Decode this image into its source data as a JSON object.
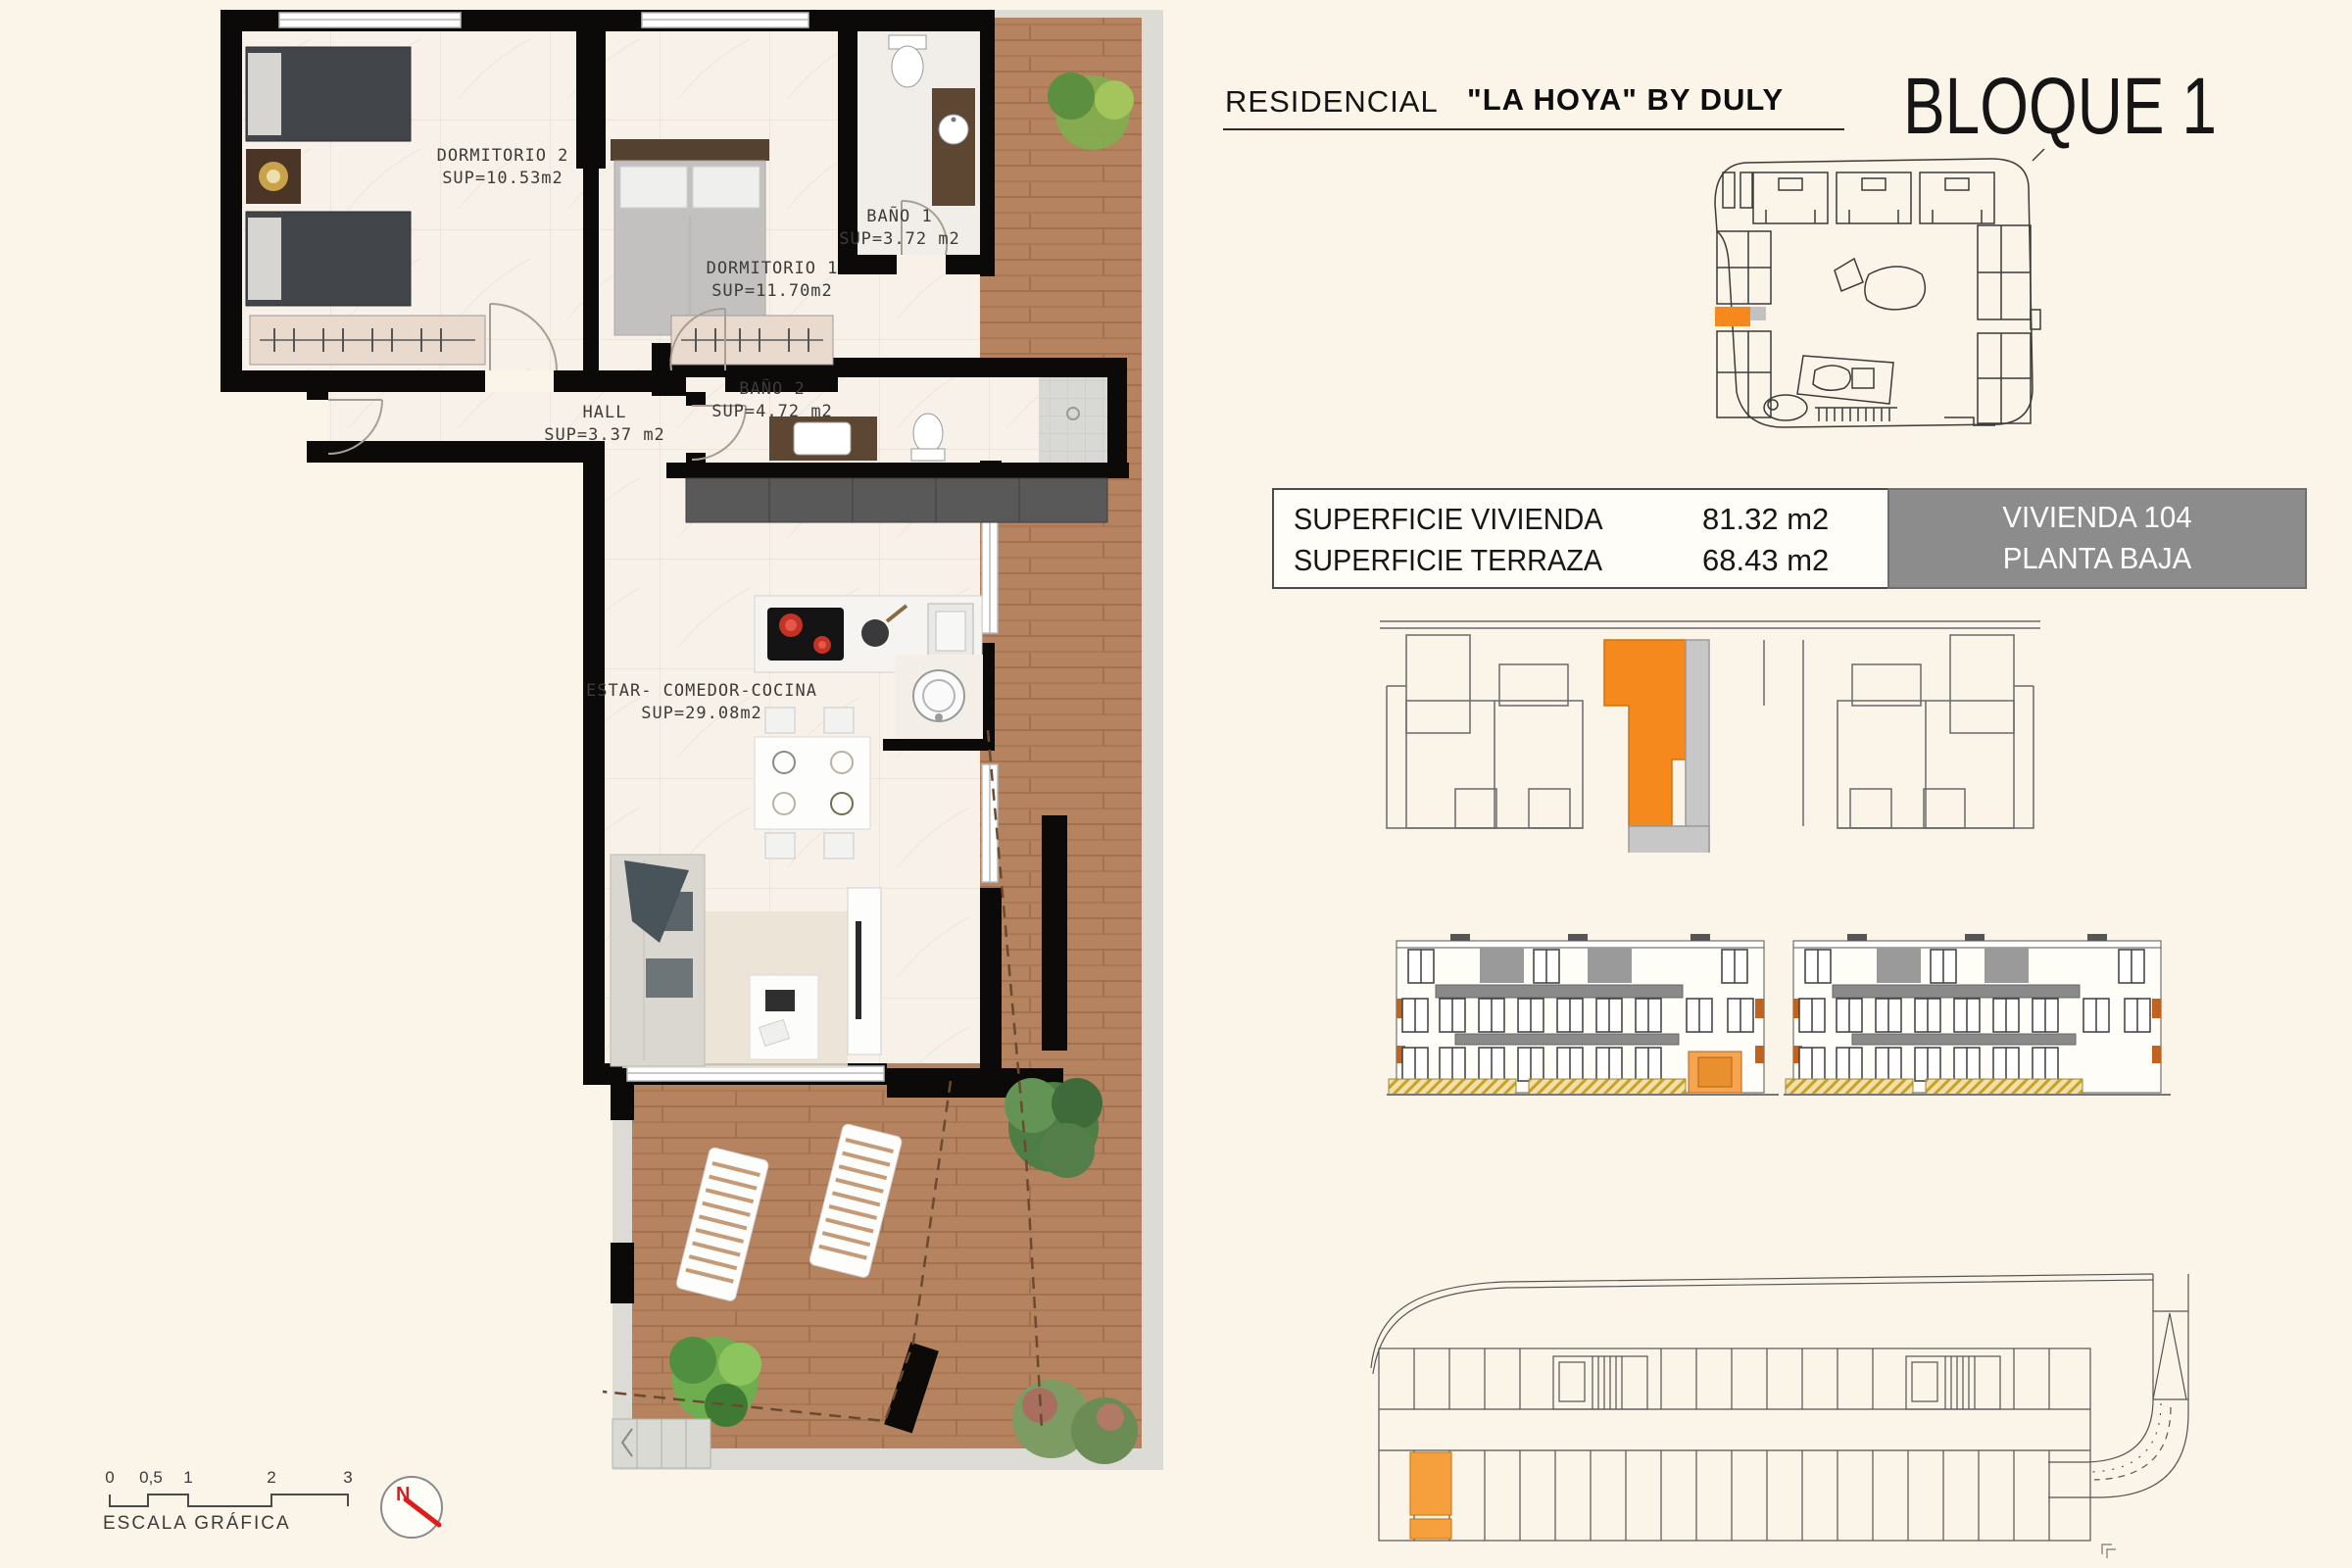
{
  "header": {
    "residencial": "RESIDENCIAL",
    "project": "\"LA HOYA\" BY DULY",
    "block": "BLOQUE 1"
  },
  "info_table": {
    "rows": [
      {
        "label": "SUPERFICIE VIVIENDA",
        "value": "81.32 m2"
      },
      {
        "label": "SUPERFICIE TERRAZA",
        "value": "68.43 m2"
      }
    ],
    "unit_box": {
      "line1": "VIVIENDA 104",
      "line2": "PLANTA BAJA"
    }
  },
  "floor_plan": {
    "rooms": [
      {
        "name": "DORMITORIO 2",
        "sup": "SUP=10.53m2"
      },
      {
        "name": "DORMITORIO 1",
        "sup": "SUP=11.70m2"
      },
      {
        "name": "BAÑO 1",
        "sup": "SUP=3.72 m2"
      },
      {
        "name": "HALL",
        "sup": "SUP=3.37 m2"
      },
      {
        "name": "BAÑO 2",
        "sup": "SUP=4.72 m2"
      },
      {
        "name": "ESTAR- COMEDOR-COCINA",
        "sup": "SUP=29.08m2"
      }
    ]
  },
  "scale_bar": {
    "ticks": [
      "0",
      "0,5",
      "1",
      "2",
      "3"
    ],
    "label": "ESCALA GRÁFICA"
  },
  "north": {
    "letter": "N"
  },
  "colors": {
    "highlight_orange": "#F5891D",
    "unit_box_gray": "#8C8C8C",
    "wood": "#B5835F",
    "wall_black": "#0B0A08",
    "north_red": "#D42020",
    "page_bg": "#FBF4E8"
  }
}
